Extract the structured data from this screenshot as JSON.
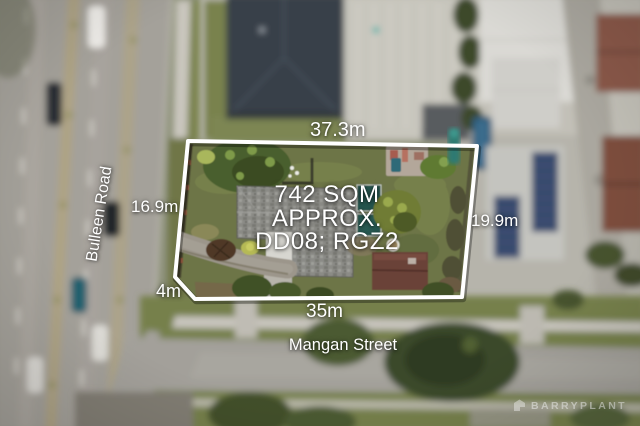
{
  "image": {
    "kind": "aerial-drone-photograph",
    "subject": "residential land parcel for sale with dimension overlay"
  },
  "overlay": {
    "dim_top": "37.3m",
    "dim_left": "16.9m",
    "dim_right": "19.9m",
    "dim_bottom": "35m",
    "dim_splay": "4m",
    "area_line1": "742 SQM",
    "area_line2": "APPROX.",
    "area_line3": "DD08; RGZ2"
  },
  "streets": {
    "west": "Bulleen Road",
    "south": "Mangan Street"
  },
  "branding": {
    "agency": "BARRYPLANT"
  },
  "palette": {
    "boundary_stroke": "#ffffff",
    "label_text": "#ffffff",
    "lawn": "#6d7546",
    "asphalt": "#a4a19a",
    "neighbor_roof_dark": "#394049",
    "property_roof": "#8c8c89",
    "solar_panel": "#35466b",
    "pool_water": "#2c5876",
    "brick": "#8a5948",
    "teal_cover": "#27564f"
  }
}
